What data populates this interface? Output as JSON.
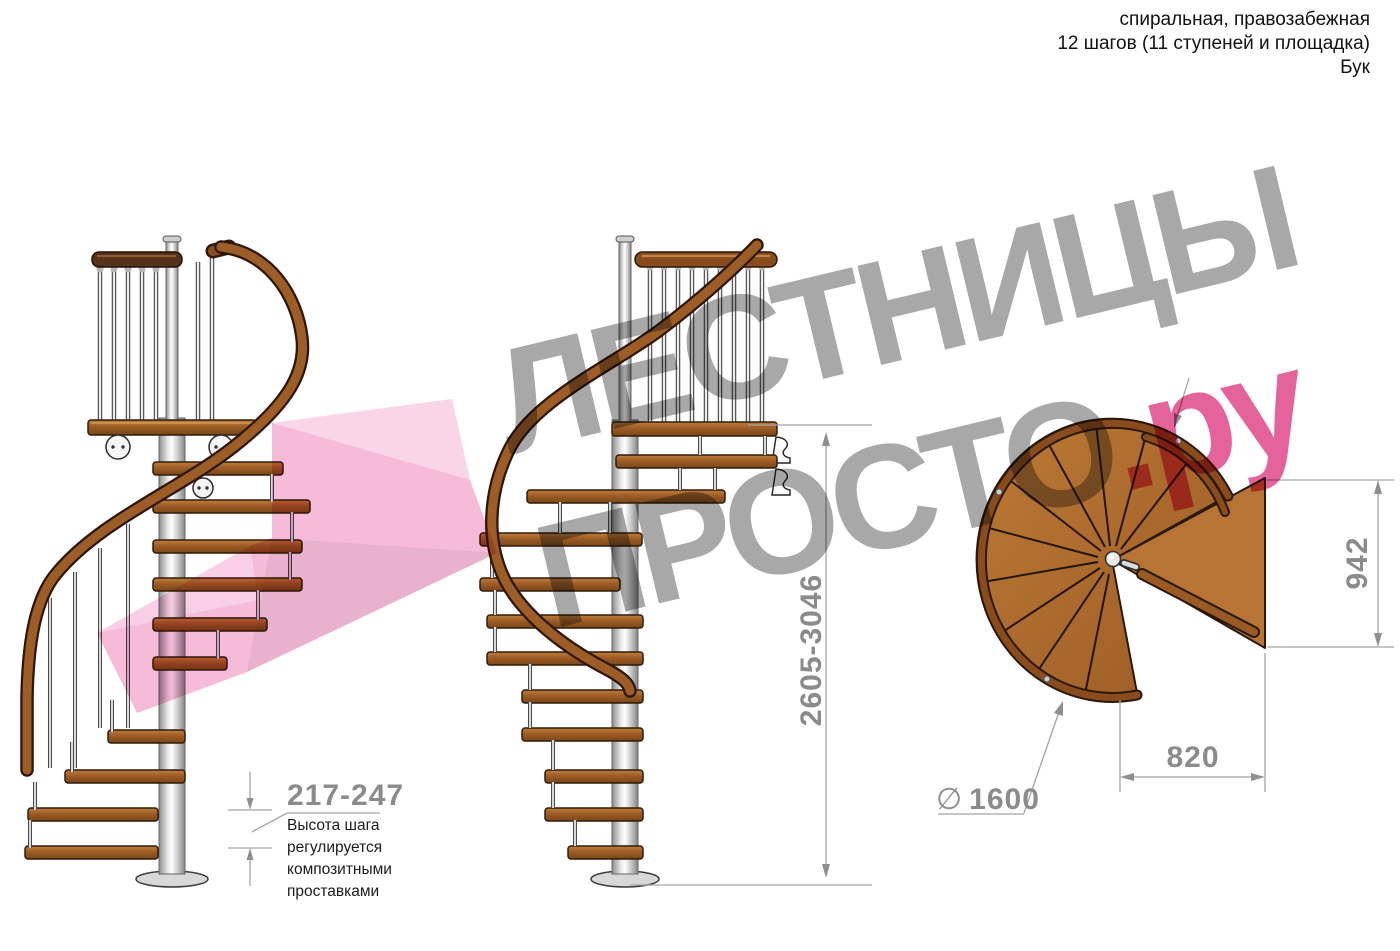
{
  "header": {
    "type_line": "спиральная, правозабежная",
    "steps_line": "12 шагов (11 ступеней и площадка)",
    "material_line": "Бук"
  },
  "watermark": {
    "word1": "ЛЕСТНИЦЫ",
    "word2_gray": "ПРОСТО",
    "word2_pink": ".ру"
  },
  "annotations": {
    "step_height": {
      "value": "217-247",
      "note": "Высота шага\nрегулируется\nкомпозитными\nпроставками"
    },
    "total_height": "2605-3046",
    "landing_depth": "942",
    "landing_width": "820",
    "diameter": {
      "symbol": "∅",
      "value": "1600"
    }
  },
  "colors": {
    "brand_pink": "#e4639a",
    "arrow_pink": "#f5bbd9",
    "watermark_gray": "#a8a8a8",
    "dimension_gray": "#8b8b8b",
    "wood": "#a8682a",
    "steel": "#d9d9d9"
  }
}
